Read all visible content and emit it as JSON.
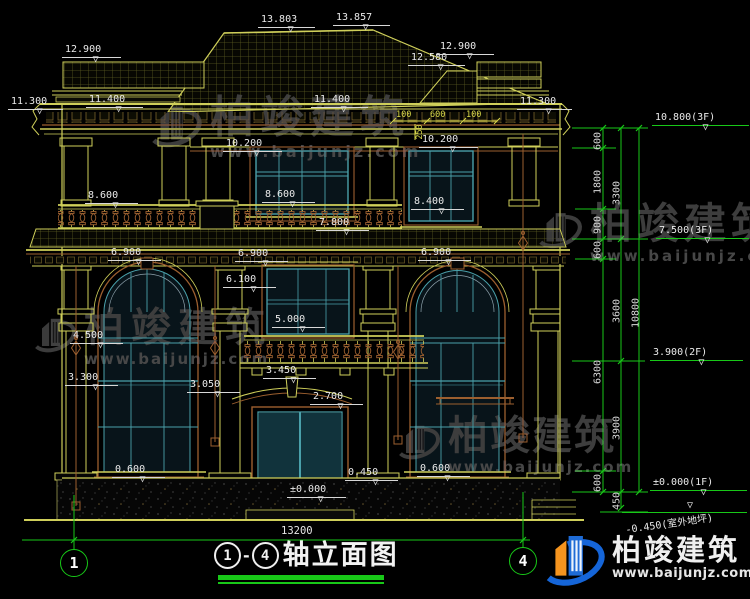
{
  "drawing": {
    "title_axis_start": "1",
    "title_axis_end": "4",
    "title_separator": "-",
    "title_text": "轴立面图",
    "overall_dim": "13200",
    "axis_bubbles": [
      "1",
      "4"
    ]
  },
  "elevation_markers": [
    "13.803",
    "13.857",
    "12.900",
    "12.580",
    "12.900",
    "11.300",
    "11.400",
    "11.400",
    "11.300",
    "10.200",
    "10.200",
    "8.600",
    "8.600",
    "8.400",
    "7.800",
    "6.900",
    "6.900",
    "6.900",
    "6.100",
    "5.000",
    "4.500",
    "3.300",
    "3.450",
    "3.050",
    "2.700",
    "0.600",
    "0.450",
    "0.600",
    "±0.000"
  ],
  "right_markers": [
    "10.800(3F)",
    "7.500(3F)",
    "3.900(2F)",
    "±0.000(1F)",
    "-0.450(室外地坪)"
  ],
  "dims": {
    "col1": [
      "600",
      "1800",
      "900",
      "600",
      "6300",
      "600"
    ],
    "col2": [
      "3300",
      "3600",
      "3900",
      "450"
    ],
    "col3": [
      "10800"
    ],
    "top": [
      "100",
      "600",
      "100"
    ],
    "top_side": "250"
  },
  "watermark": {
    "name": "柏竣建筑",
    "url": "www.baijunjz.com"
  },
  "footer": {
    "name": "柏竣建筑",
    "url": "www.baijunjz.com"
  },
  "colors": {
    "line_yellow": "#cfcf5a",
    "dim_green": "#18c818",
    "frame_teal": "#4aa0aa",
    "trim_brown": "#9c5f2f",
    "text_white": "#e6e6e6",
    "brand_blue": "#1e6bd6",
    "brand_orange": "#f5941e"
  }
}
